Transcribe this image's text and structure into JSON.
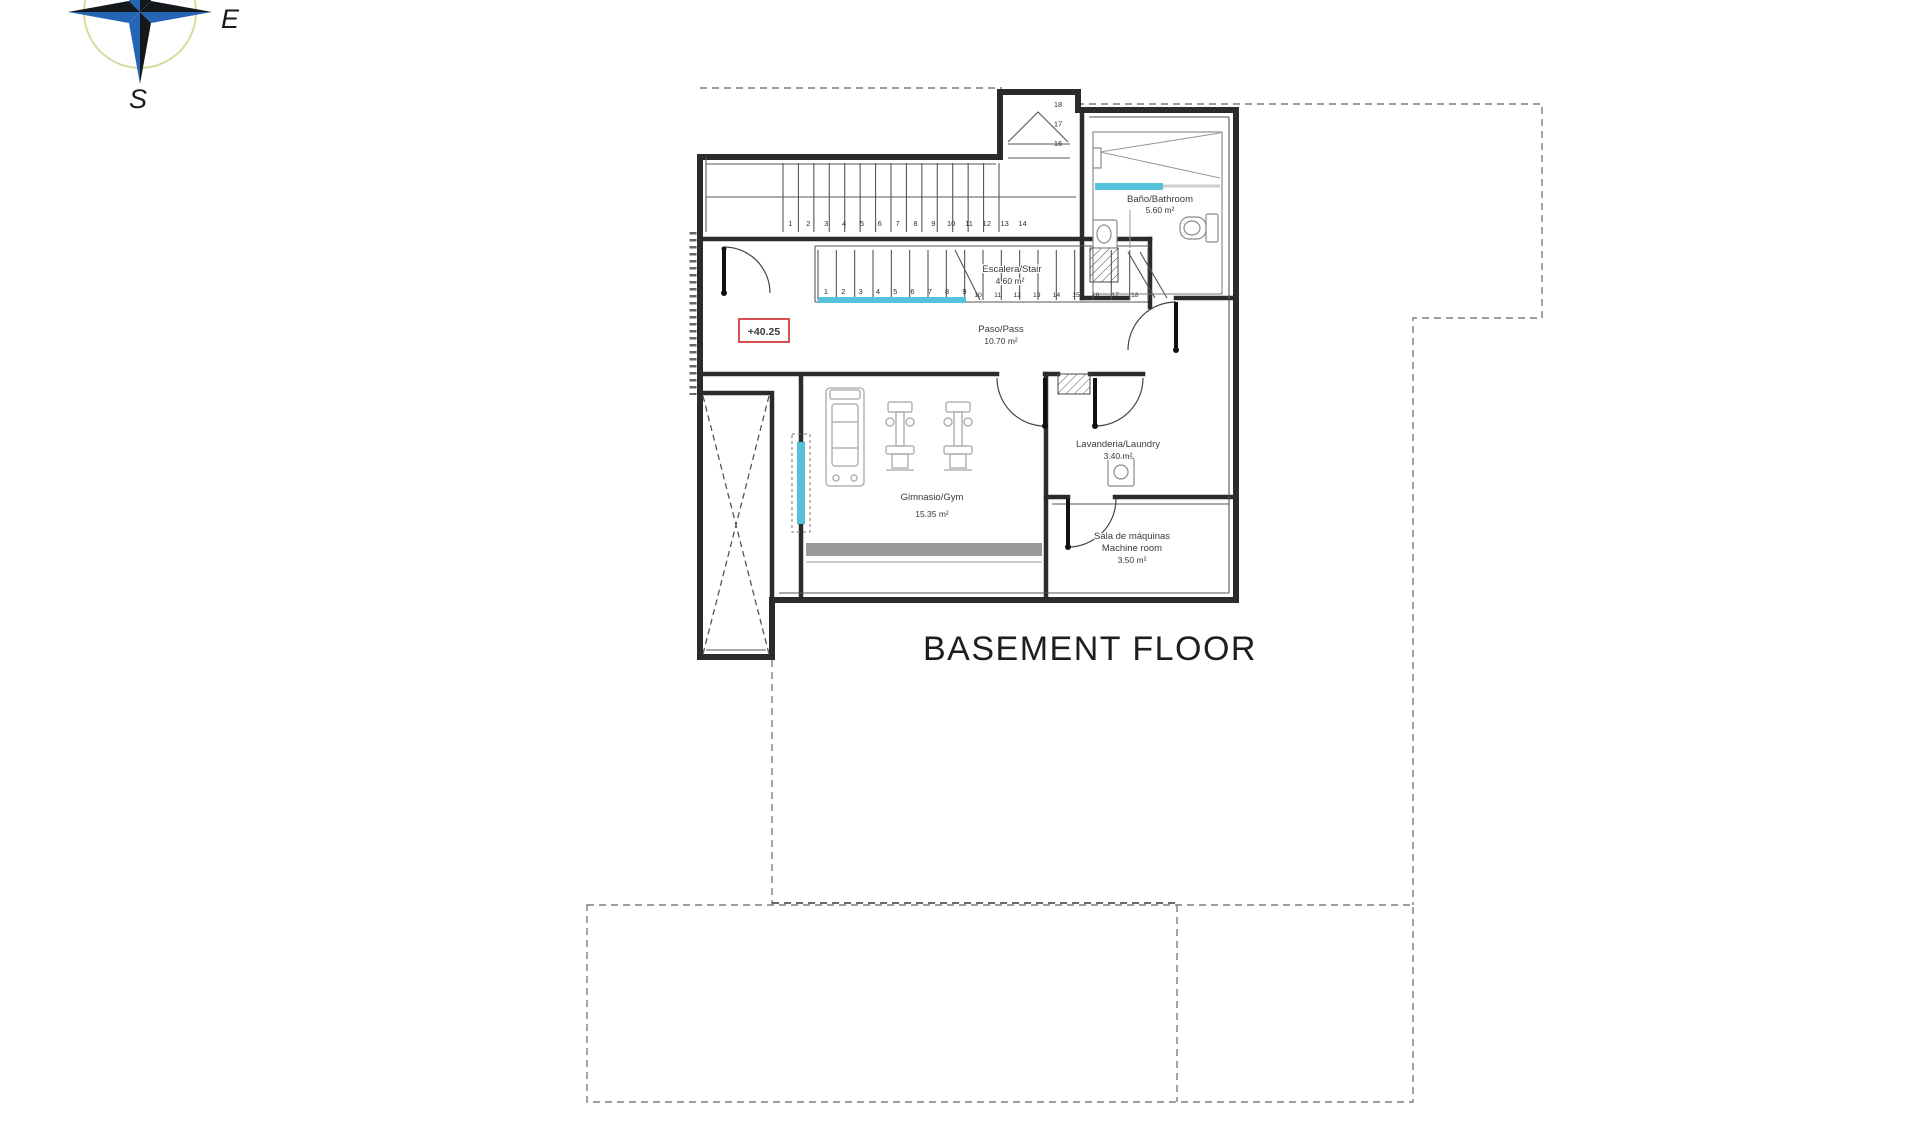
{
  "title": "BASEMENT FLOOR",
  "compass": {
    "east": "E",
    "south": "S"
  },
  "level_marker": "+40.25",
  "rooms": {
    "bathroom": {
      "name": "Baño/Bathroom",
      "area": "5.60 m²"
    },
    "stair": {
      "name": "Escalera/Stair",
      "area": "4.60 m²"
    },
    "hall": {
      "name": "Paso/Pass",
      "area": "10.70 m²"
    },
    "gym": {
      "name": "Gimnasio/Gym",
      "area": "15.35 m²"
    },
    "laundry": {
      "name": "Lavanderia/Laundry",
      "area": "3.40 m²"
    },
    "machine_room": {
      "name_es": "Sala de máquinas",
      "name_en": "Machine room",
      "area": "3.50 m²"
    }
  },
  "stairs": {
    "flight_upper": [
      "1",
      "2",
      "3",
      "4",
      "5",
      "6",
      "7",
      "8",
      "9",
      "10",
      "11",
      "12",
      "13",
      "14"
    ],
    "flight_upper_turn": [
      "18",
      "17",
      "16"
    ],
    "flight_lower_a": [
      "1",
      "2",
      "3",
      "4",
      "5",
      "6",
      "7",
      "8",
      "9"
    ],
    "flight_lower_b": [
      "10",
      "11",
      "12",
      "13",
      "14",
      "15",
      "16",
      "17",
      "18"
    ]
  },
  "colors": {
    "glass_cyan": "#54c2da",
    "marker_red": "#d43c3c",
    "wall": "#2b2b2b",
    "detail": "#555555",
    "fixture_gray": "#9b9b9b",
    "equipment_gray": "#b3b3b3",
    "boundary_gray": "#7d7d7d",
    "compass_blue": "#2465b5",
    "compass_dark": "#14181c",
    "compass_ring": "#d6db9b"
  }
}
